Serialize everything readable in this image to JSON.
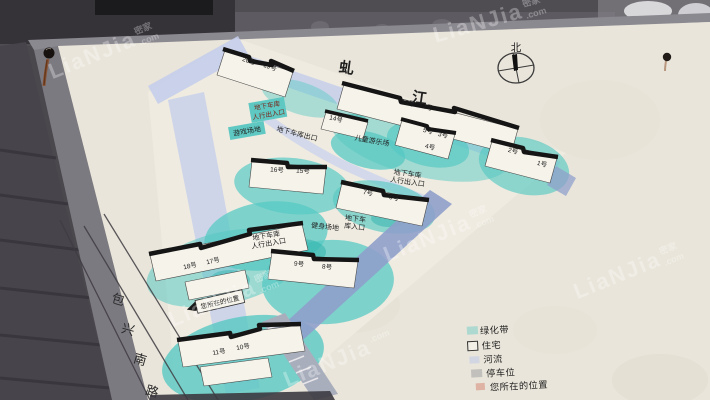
{
  "watermark": {
    "text": "LiaNJia",
    "cjk": "密家",
    "suffix": ".com"
  },
  "map": {
    "river_chars": [
      {
        "ch": "虬"
      },
      {
        "ch": "江"
      }
    ],
    "compass": {
      "north_label": "北"
    },
    "road_chars": [
      {
        "ch": "包"
      },
      {
        "ch": "兴"
      },
      {
        "ch": "南"
      },
      {
        "ch": "路"
      }
    ],
    "building_labels": [
      {
        "text": "20号"
      },
      {
        "text": "19号"
      },
      {
        "text": "13号"
      },
      {
        "text": "12号"
      },
      {
        "text": "14号"
      },
      {
        "text": "5号"
      },
      {
        "text": "3号"
      },
      {
        "text": "4号"
      },
      {
        "text": "2号"
      },
      {
        "text": "1号"
      },
      {
        "text": "16号"
      },
      {
        "text": "15号"
      },
      {
        "text": "7号"
      },
      {
        "text": "6号"
      },
      {
        "text": "18号"
      },
      {
        "text": "17号"
      },
      {
        "text": "9号"
      },
      {
        "text": "8号"
      },
      {
        "text": "11号"
      },
      {
        "text": "10号"
      }
    ],
    "annotations": [
      {
        "line1": "地下车库",
        "line2": "人行出入口"
      },
      {
        "line1": "游戏场地"
      },
      {
        "line1": "地下车库出口"
      },
      {
        "line1": "儿童游乐场"
      },
      {
        "line1": "地下车库",
        "line2": "人行出入口"
      },
      {
        "line1": "健身场地"
      },
      {
        "line1": "地下车",
        "line2": "库入口"
      },
      {
        "line1": "地下车库",
        "line2": "人行出入口"
      },
      {
        "line1": "您所在的位置"
      }
    ],
    "legend": {
      "items": [
        {
          "label": "绿化带"
        },
        {
          "label": "住宅"
        },
        {
          "label": "河流"
        },
        {
          "label": "停车位"
        },
        {
          "label": "您所在的位置"
        }
      ]
    }
  },
  "colors": {
    "board": "#e9e5da",
    "greenbelt_teal": "#57c9c3",
    "road_lavender": "#c3cdeb",
    "boundary_slate": "#8fa0cb",
    "rust": "#8a4a22"
  }
}
